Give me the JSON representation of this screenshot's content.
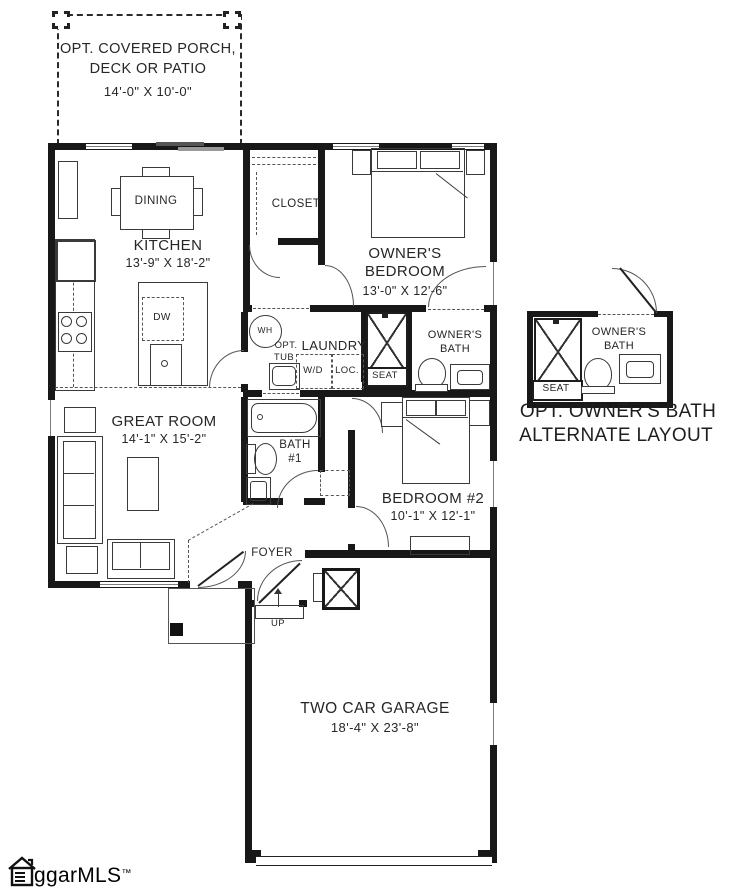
{
  "labels": {
    "porch_l1": "OPT. COVERED PORCH,",
    "porch_l2": "DECK OR PATIO",
    "porch_dims": "14'-0\" X 10'-0\"",
    "dining": "DINING",
    "kitchen": "KITCHEN",
    "kitchen_dims": "13'-9\" X 18'-2\"",
    "closet": "CLOSET",
    "owners_bedroom_l1": "OWNER'S",
    "owners_bedroom_l2": "BEDROOM",
    "owners_bedroom_dims": "13'-0\" X 12'-6\"",
    "wh": "WH",
    "dw": "DW",
    "opt_tub_l1": "OPT.",
    "opt_tub_l2": "TUB",
    "laundry": "LAUNDRY",
    "wd": "W/D",
    "loc": "LOC.",
    "seat": "SEAT",
    "owners_bath_l1": "OWNER'S",
    "owners_bath_l2": "BATH",
    "great_room": "GREAT ROOM",
    "great_room_dims": "14'-1\" X 15'-2\"",
    "bath1_l1": "BATH",
    "bath1_l2": "#1",
    "bedroom2": "BEDROOM #2",
    "bedroom2_dims": "10'-1\" X 12'-1\"",
    "foyer": "FOYER",
    "up": "UP",
    "garage": "TWO CAR GARAGE",
    "garage_dims": "18'-4\" X 23'-8\"",
    "alt_bath_l1": "OWNER'S",
    "alt_bath_l2": "BATH",
    "alt_seat": "SEAT",
    "alt_caption_l1": "OPT. OWNER'S BATH",
    "alt_caption_l2": "ALTERNATE LAYOUT",
    "logo_text": "ggarMLS",
    "logo_tm": "™"
  },
  "colors": {
    "wall": "#181818",
    "line": "#3a3a3a",
    "text": "#262626"
  }
}
